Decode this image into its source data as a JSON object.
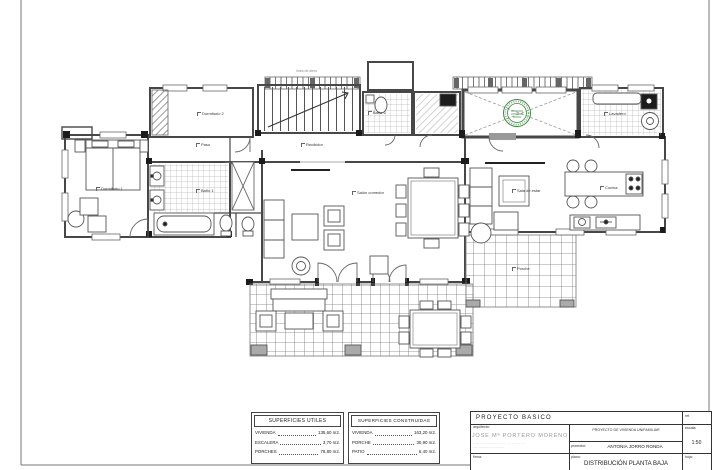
{
  "sheet": {
    "bg": "#ffffff",
    "border_color": "#666666"
  },
  "stamp": {
    "color": "#3f8a3f",
    "name": "colegio-arquitectos-visa-stamp"
  },
  "rooms": {
    "dormitorio2": "Dormitorio 2",
    "bano2": "Baño 2",
    "lavadero": "Lavadero",
    "paso": "Paso",
    "recibidor": "Recibidor",
    "dormitorio1": "Dormitorio 1",
    "bano1": "Baño 1",
    "salon": "Salón comedor",
    "sala_estar": "Sala de estar",
    "cocina": "Cocina",
    "porche": "Porche",
    "eave": "línea de alero"
  },
  "tables": {
    "utiles": {
      "title": "SUPERFICIES UTILES",
      "rows": [
        {
          "name": "VIVIENDA",
          "value": "135,60 m2."
        },
        {
          "name": "ESCALERA",
          "value": "3,70 m2."
        },
        {
          "name": "PORCHES",
          "value": "78,80 m2."
        }
      ]
    },
    "construidas": {
      "title": "SUPERFICIES CONSTRUIDAS",
      "rows": [
        {
          "name": "VIVIENDA",
          "value": "163,20 m2."
        },
        {
          "name": "PORCHE",
          "value": "30,90 m2."
        },
        {
          "name": "PATIO",
          "value": "6,40 m2."
        }
      ]
    }
  },
  "titleblock": {
    "project_type": "PROYECTO BASICO",
    "ref_label": "ref.",
    "architect_label": "arquitecto:",
    "architect_name": "JOSE Mª PORTERO MORENO",
    "architect_contact": "·· ··· · · ··· ··· ······ ·· · ·· · · ·· ·· · · ·· ·· ·",
    "architect_contact2": "····· ··········· ·········· ···",
    "project_label": "PROYECTO  DE  VIVIENDA  UNIFAMILIAR",
    "promoter_label": "promotor:",
    "promoter_name": "ANTONIA  JORRO  RONDA",
    "scale_label": "escala:",
    "scale_value": "1:50",
    "signature_label": "firma:",
    "plan_label": "plano:",
    "plan_name": "DISTRIBUCIÓN  PLANTA  BAJA",
    "page_label": "hoja:"
  }
}
